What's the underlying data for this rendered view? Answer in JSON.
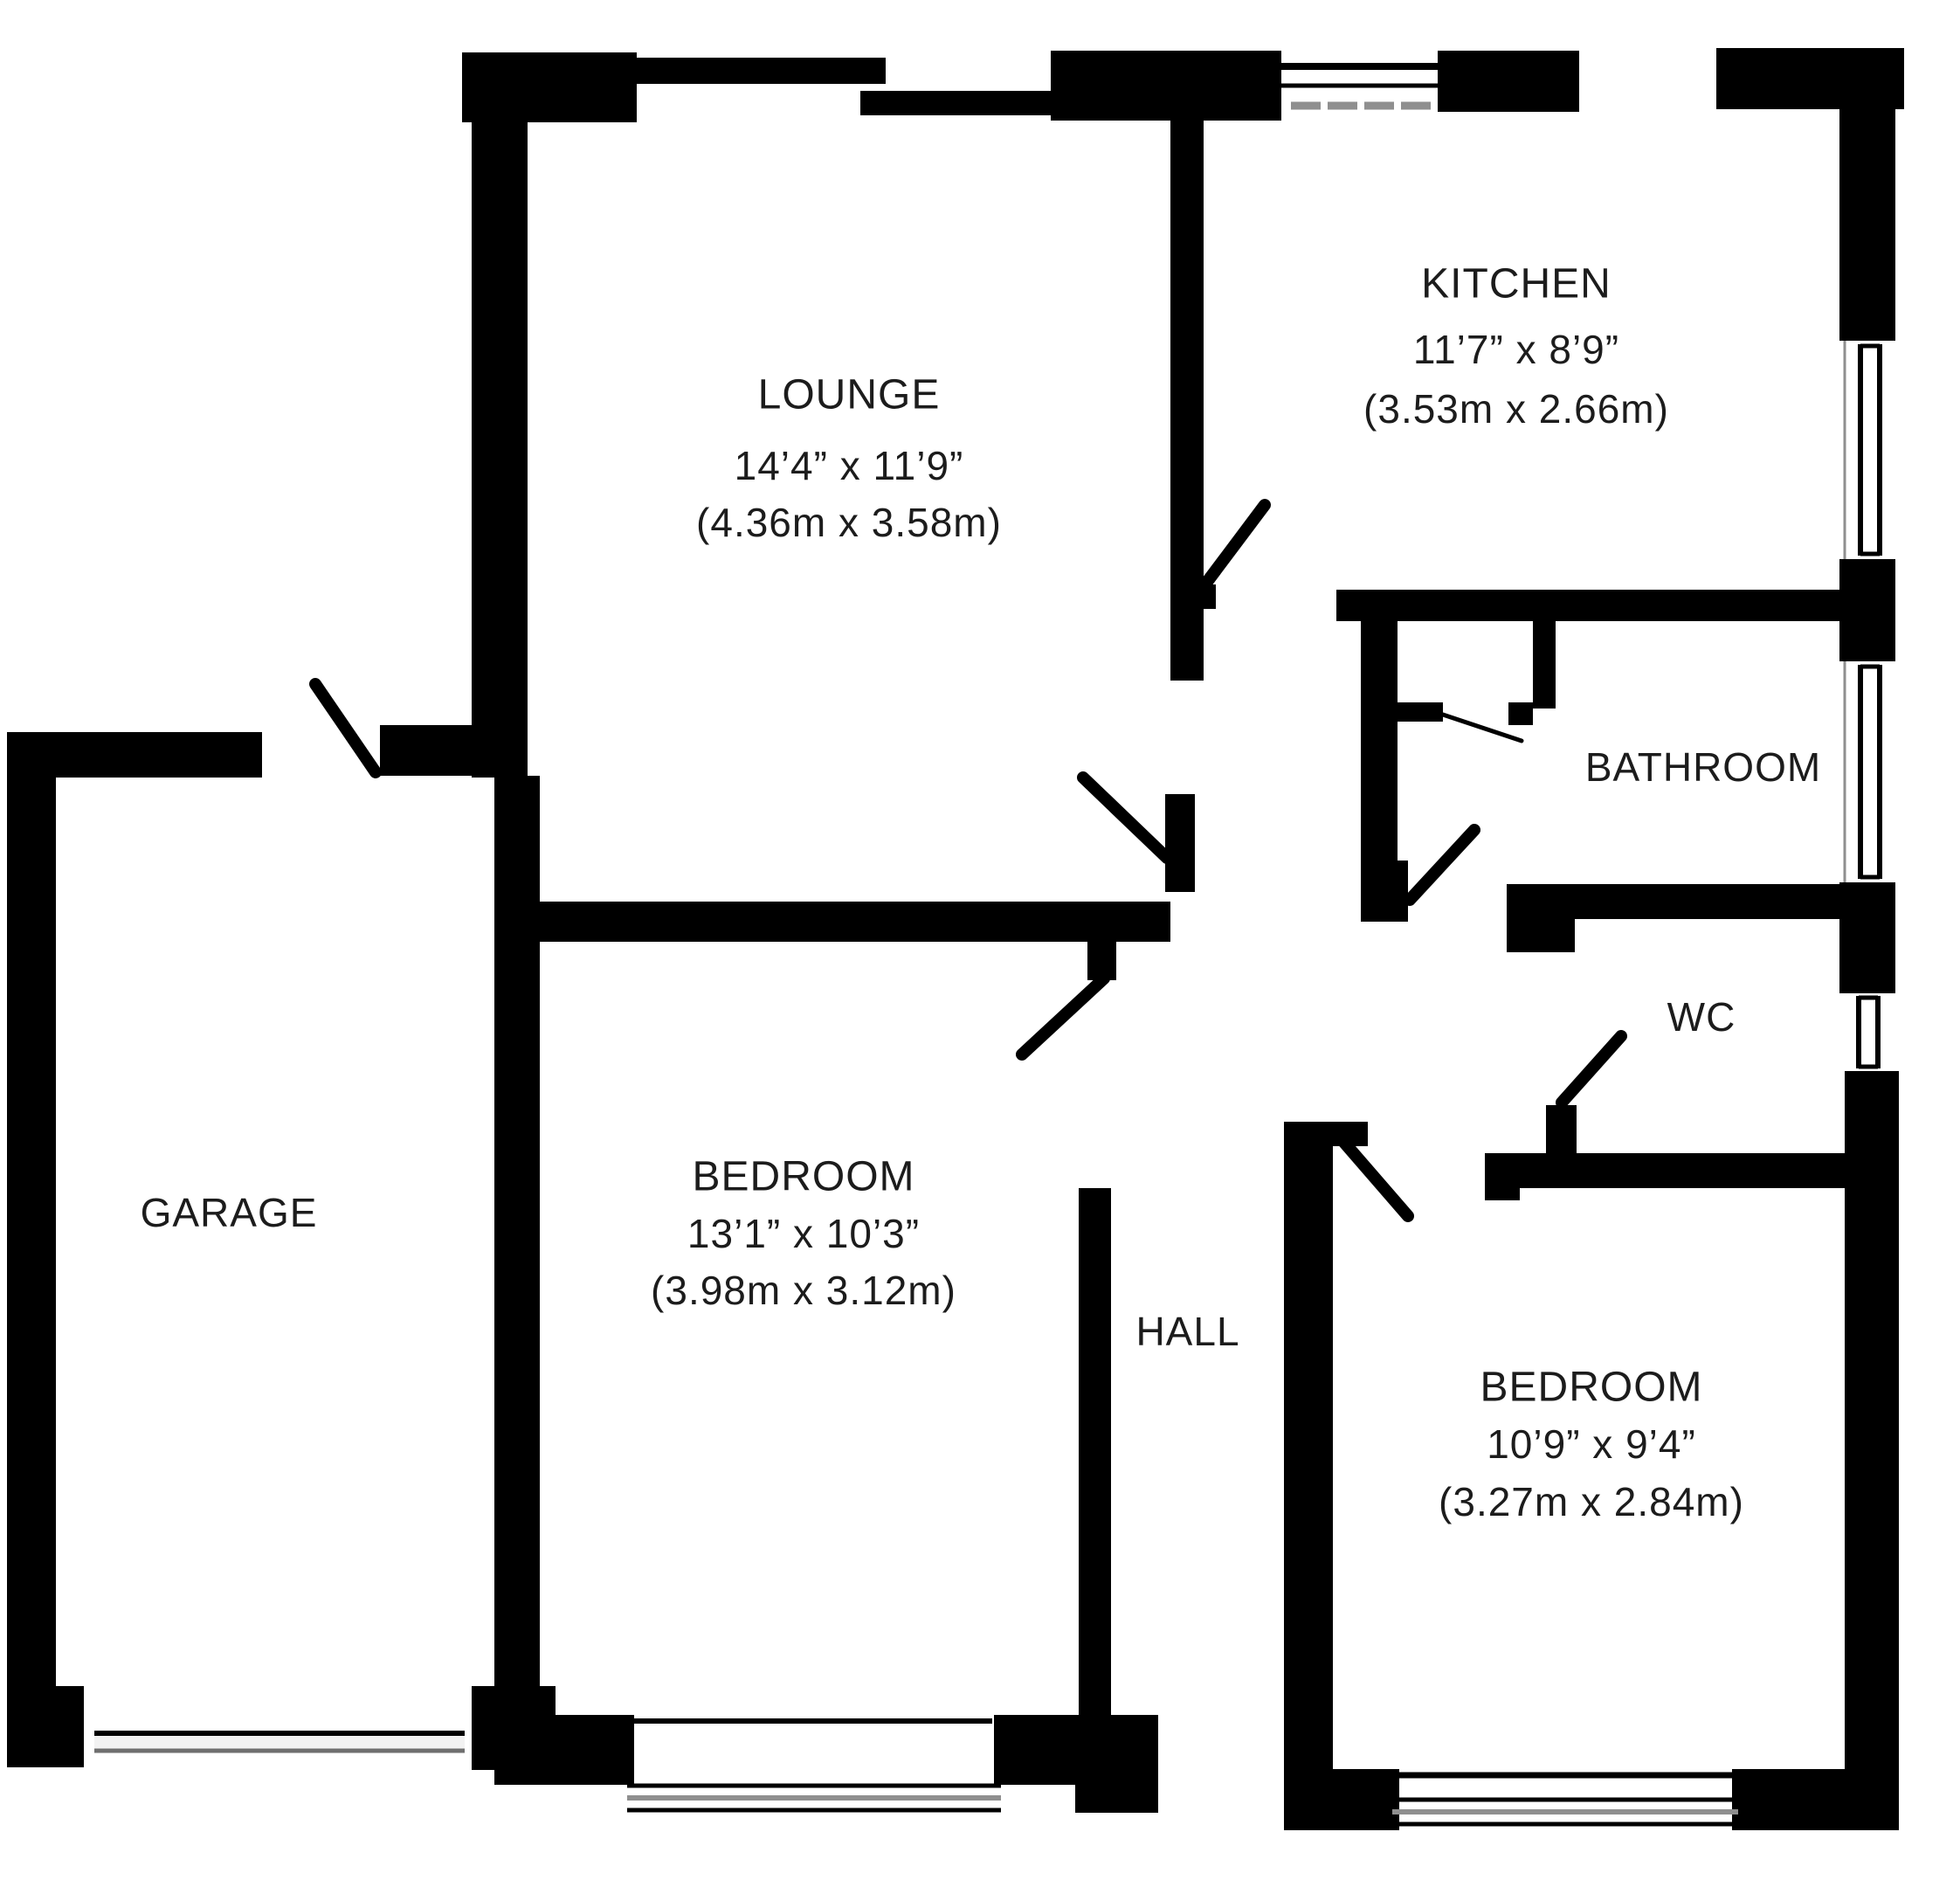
{
  "title": "Bungalow floor plan",
  "colors": {
    "wall": "#000000",
    "background": "#ffffff",
    "window_gray": "#8f8f8f",
    "text": "#1c1c1c"
  },
  "rooms": {
    "lounge": {
      "name": "LOUNGE",
      "imperial": "14’4” x 11’9”",
      "metric": "(4.36m x 3.58m)"
    },
    "kitchen": {
      "name": "KITCHEN",
      "imperial": "11’7” x 8’9”",
      "metric": "(3.53m x 2.66m)"
    },
    "bathroom": {
      "name": "BATHROOM"
    },
    "wc": {
      "name": "WC"
    },
    "garage": {
      "name": "GARAGE"
    },
    "bedroom_left": {
      "name": "BEDROOM",
      "imperial": "13’1” x 10’3”",
      "metric": "(3.98m x 3.12m)"
    },
    "hall": {
      "name": "HALL"
    },
    "bedroom_right": {
      "name": "BEDROOM",
      "imperial": "10’9” x 9’4”",
      "metric": "(3.27m x 2.84m)"
    }
  }
}
